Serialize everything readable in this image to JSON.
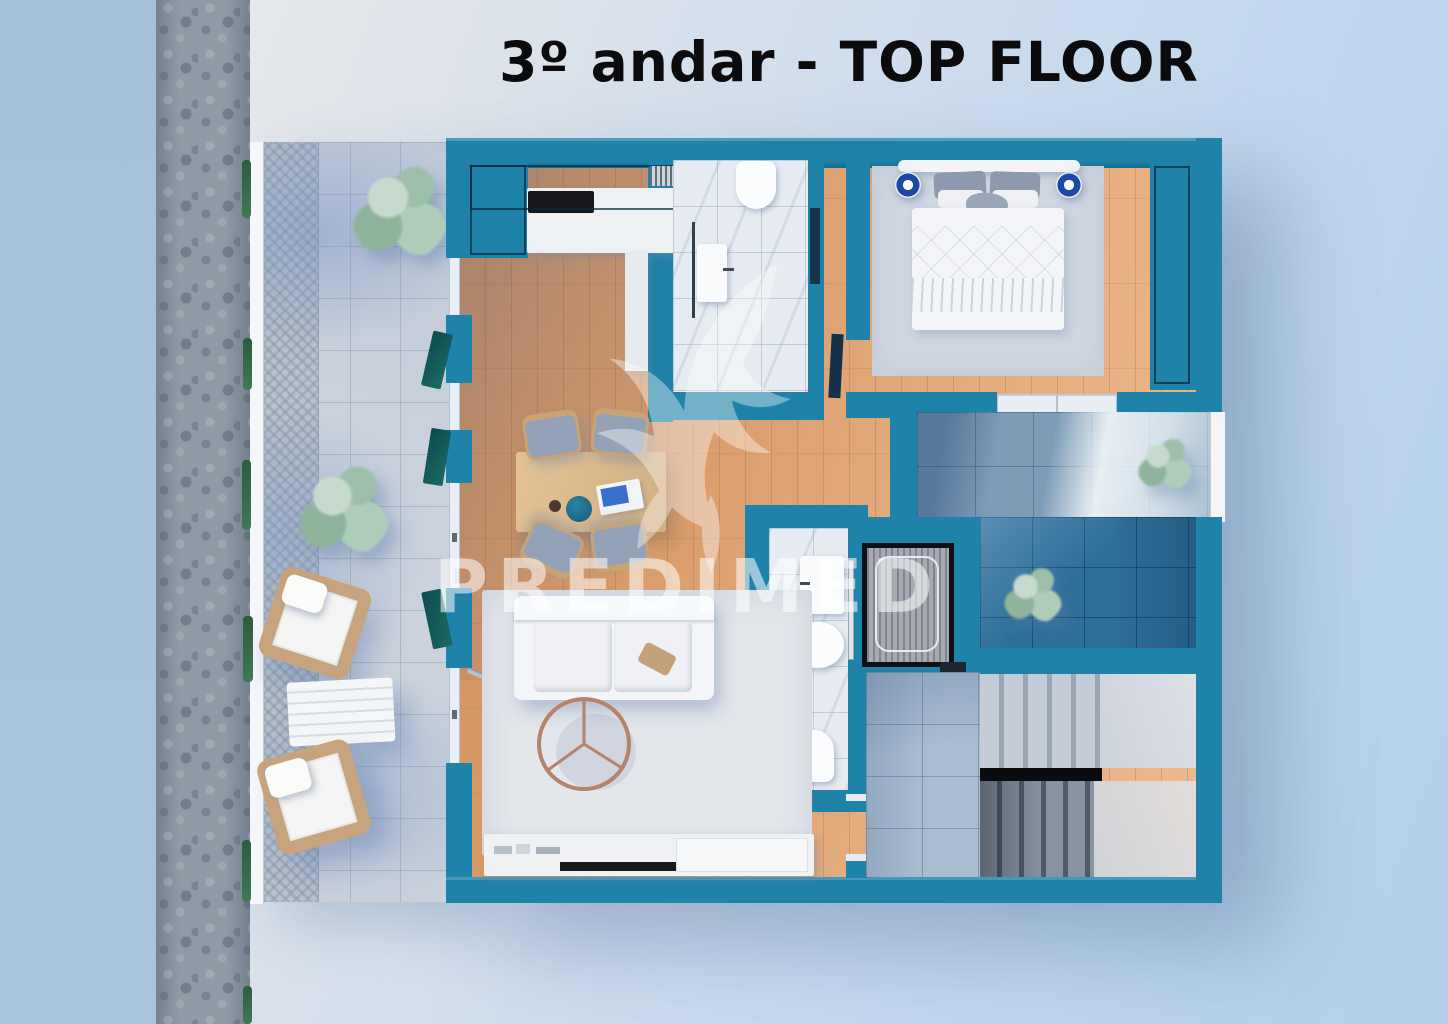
{
  "page": {
    "title": "3º andar - TOP FLOOR"
  },
  "watermark": {
    "text": "PREDIMED",
    "logo": "dove-swirl-logo"
  },
  "palette": {
    "background_left": "#A8C2D9",
    "background_main": "#CFDEEF",
    "cobblestone": "#8E9AA6",
    "wall_teal": "#1F82A9",
    "wood_floor": "#DCA173",
    "terrace_tile": "#CBD2DD",
    "marble_tile": "#E7ECF2",
    "upper_terrace_tile": "#7C9CB7",
    "lower_terrace_tile": "#2E6F9A",
    "stair_dark": "#4F5A68",
    "accent_black": "#0B0C0F"
  }
}
